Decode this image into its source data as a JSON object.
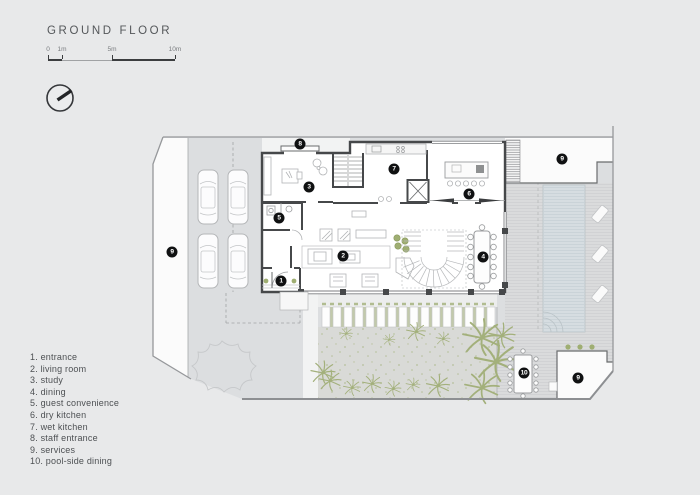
{
  "header": {
    "title": "GROUND FLOOR"
  },
  "scalebar": {
    "ticks": [
      {
        "label": "0",
        "x": 48
      },
      {
        "label": "1m",
        "x": 62
      },
      {
        "label": "5m",
        "x": 112
      },
      {
        "label": "10m",
        "x": 175
      }
    ],
    "segments": [
      {
        "x1": 48,
        "x2": 62,
        "thick": true
      },
      {
        "x1": 62,
        "x2": 112,
        "thick": false
      },
      {
        "x1": 112,
        "x2": 175,
        "thick": true
      }
    ]
  },
  "north_indicator": {
    "style": "circle-needle"
  },
  "legend": {
    "items": [
      {
        "n": "1",
        "label": "entrance"
      },
      {
        "n": "2",
        "label": "living room"
      },
      {
        "n": "3",
        "label": "study"
      },
      {
        "n": "4",
        "label": "dining"
      },
      {
        "n": "5",
        "label": "guest convenience"
      },
      {
        "n": "6",
        "label": "dry kitchen"
      },
      {
        "n": "7",
        "label": "wet kitchen"
      },
      {
        "n": "8",
        "label": "staff entrance"
      },
      {
        "n": "9",
        "label": "services"
      },
      {
        "n": "10",
        "label": "pool-side dining"
      }
    ]
  },
  "plan": {
    "badges": [
      {
        "n": "1",
        "x": 281,
        "y": 281
      },
      {
        "n": "2",
        "x": 343,
        "y": 256
      },
      {
        "n": "3",
        "x": 309,
        "y": 187
      },
      {
        "n": "4",
        "x": 483,
        "y": 257
      },
      {
        "n": "5",
        "x": 279,
        "y": 218
      },
      {
        "n": "6",
        "x": 469,
        "y": 194
      },
      {
        "n": "7",
        "x": 394,
        "y": 169
      },
      {
        "n": "8",
        "x": 300,
        "y": 144
      },
      {
        "n": "9",
        "x": 172,
        "y": 252
      },
      {
        "n": "9",
        "x": 562,
        "y": 159
      },
      {
        "n": "9",
        "x": 578,
        "y": 378
      },
      {
        "n": "10",
        "x": 524,
        "y": 373
      }
    ],
    "colors": {
      "background": "#e8e9ea",
      "site": "#dcdee0",
      "deck": "#dadbdc",
      "pool": "#d6dde1",
      "wall": "#46484a",
      "furniture": "#b2b4b6",
      "green": "#a3b07b",
      "badge": "#101112"
    }
  }
}
